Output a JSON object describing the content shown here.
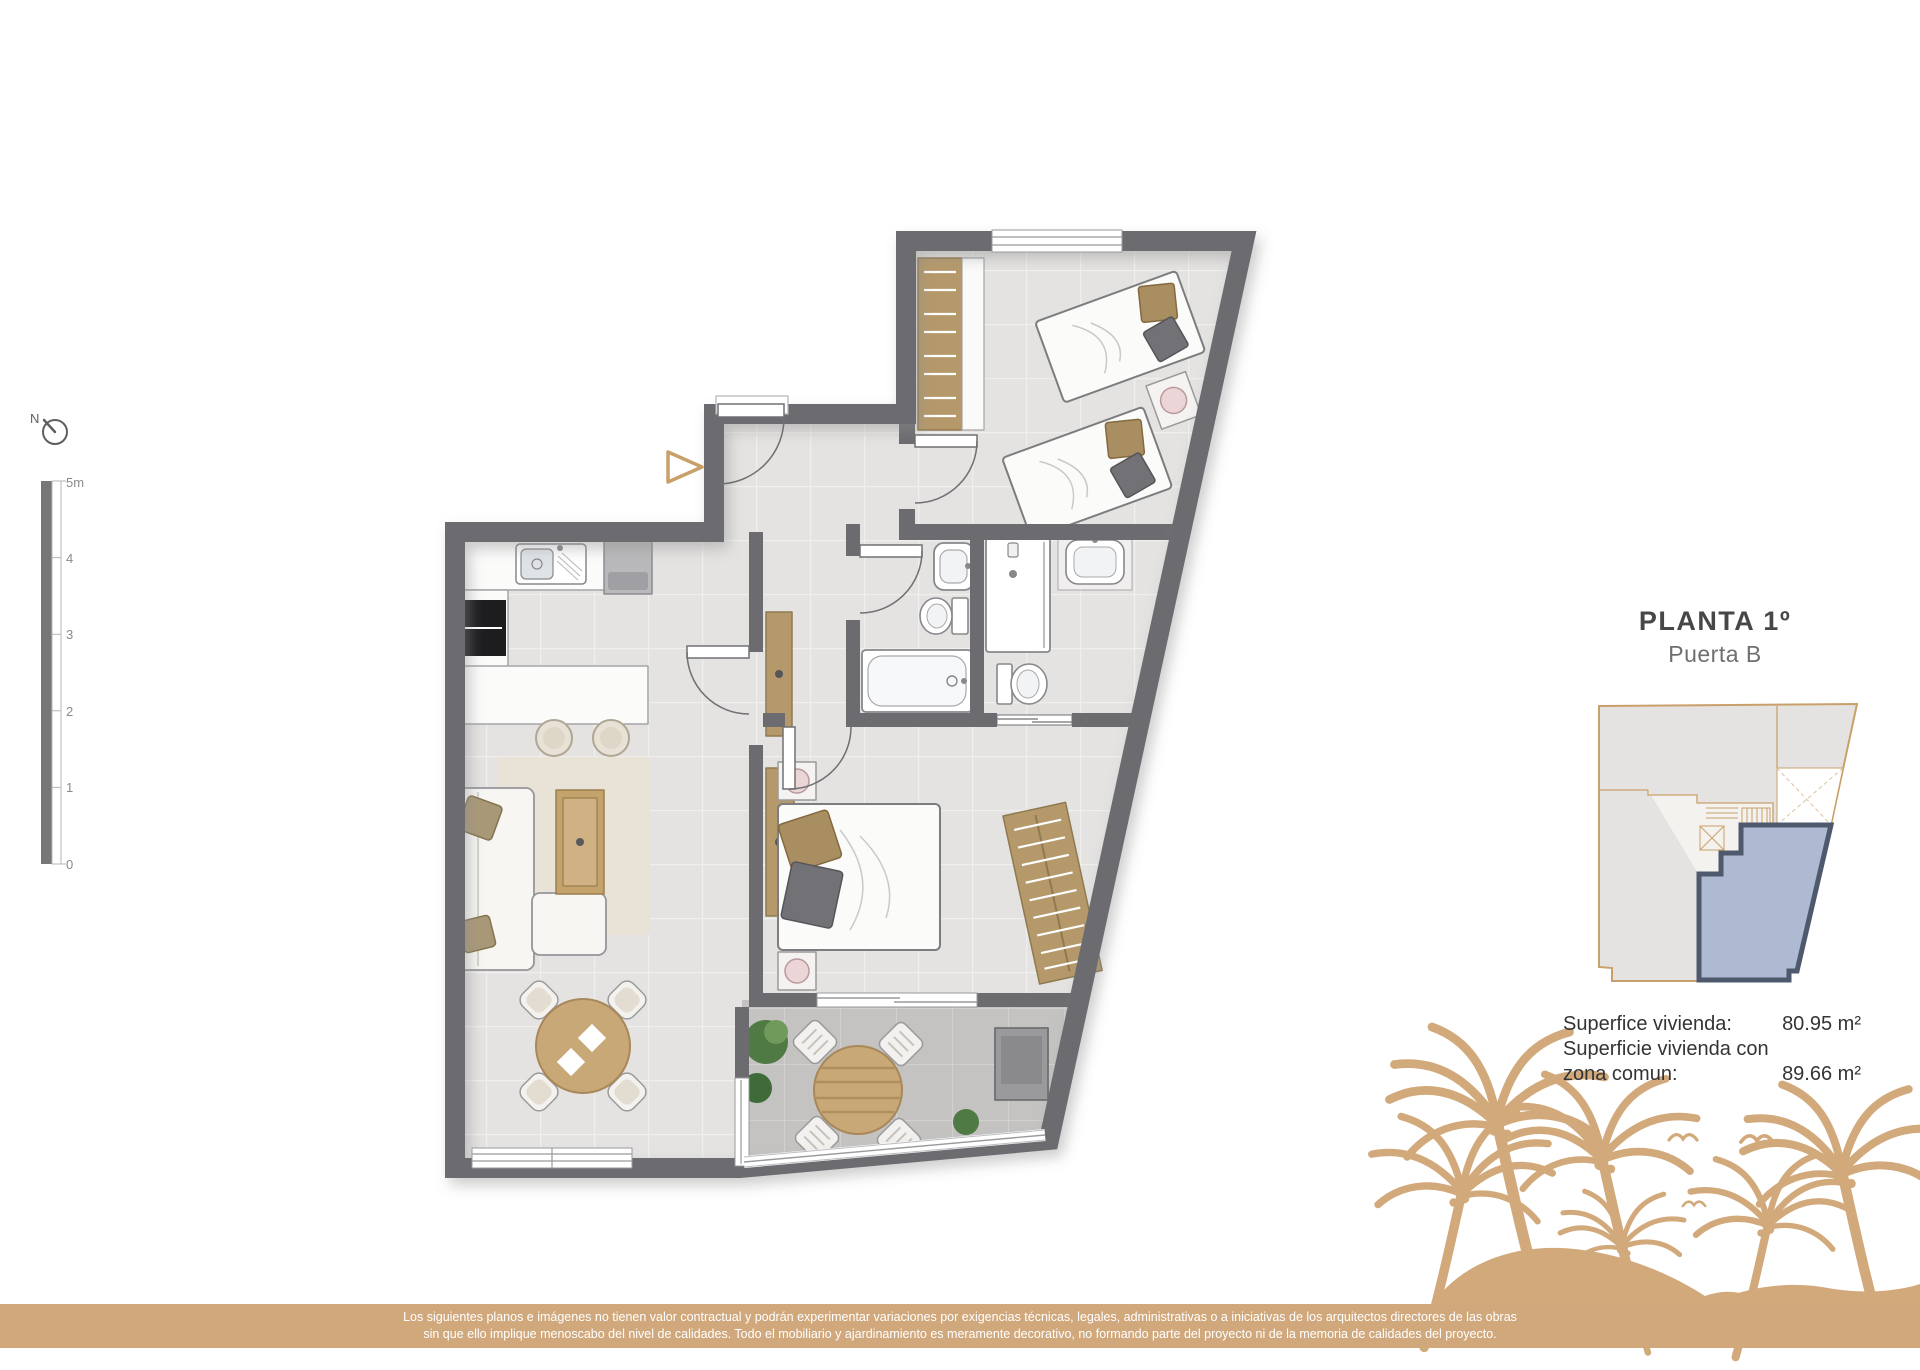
{
  "header": {
    "title": "PLANTA 1º",
    "subtitle": "Puerta B"
  },
  "areas": {
    "rows": [
      {
        "label": "Superfice vivienda:",
        "value": "80.95 m²"
      },
      {
        "label": "Superficie vivienda con",
        "value": ""
      },
      {
        "label": "zona comun:",
        "value": "89.66 m²"
      }
    ]
  },
  "scale_bar": {
    "unit_labels": [
      "5m",
      "4",
      "3",
      "2",
      "1",
      "0"
    ]
  },
  "compass": {
    "label": "N"
  },
  "footer": {
    "line1": "Los siguientes planos e imágenes no tienen valor contractual y podrán experimentar variaciones por exigencias técnicas, legales, administrativas o a iniciativas de los arquitectos directores de las obras",
    "line2": "sin que ello implique menoscabo del nivel de calidades. Todo el mobiliario y ajardinamiento es meramente decorativo, no formando parte del proyecto ni de la memoria de calidades del proyecto."
  },
  "colors": {
    "accent_tan": "#d0a87c",
    "wall_gray": "#6c6c70",
    "wardrobe_tan": "#b5996a",
    "wood": "#c9a877",
    "highlight_blue": "#aeb9d2",
    "highlight_border": "#4e596e",
    "minimap_line": "#c9a06a"
  }
}
